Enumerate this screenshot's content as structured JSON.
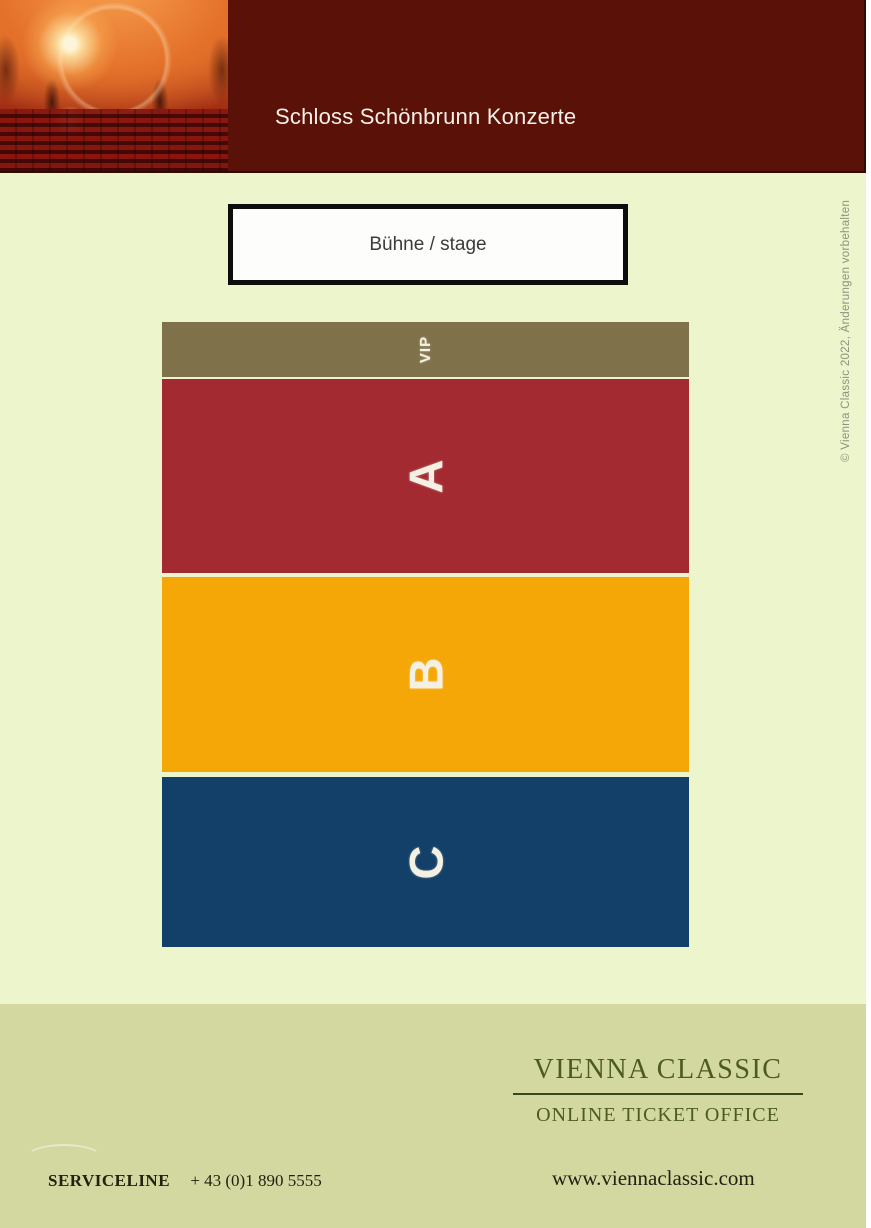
{
  "header": {
    "title": "Schloss Schönbrunn Konzerte"
  },
  "stage": {
    "label": "Bühne / stage"
  },
  "seat_map": {
    "sections": [
      {
        "id": "vip",
        "label": "VIP",
        "color": "#7f724a"
      },
      {
        "id": "a",
        "label": "A",
        "color": "#a42a32"
      },
      {
        "id": "b",
        "label": "B",
        "color": "#f5a707"
      },
      {
        "id": "c",
        "label": "C",
        "color": "#134068"
      }
    ]
  },
  "copyright_note": "© Vienna Classic 2022, Änderungen vorbehalten",
  "footer": {
    "brand_title": "VIENNA CLASSIC",
    "brand_tagline": "ONLINE TICKET OFFICE",
    "serviceline_label": "SERVICELINE",
    "serviceline_number": "+ 43 (0)1 890 5555",
    "website": "www.viennaclassic.com"
  },
  "colors": {
    "header_bg": "#5a1108",
    "page_bg": "#edf5cd",
    "footer_bg": "#d3d8a1",
    "brand_green": "#4c5c20",
    "stage_border": "#0d0d0d",
    "section_label_text": "#f5f1e2",
    "copyright_text": "#8b9280"
  }
}
